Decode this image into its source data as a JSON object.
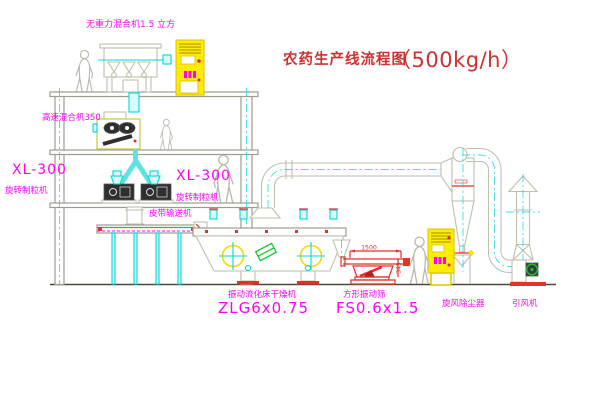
{
  "title": {
    "name": "农药生产线流程图",
    "capacity": "（500kg/h）"
  },
  "labels": {
    "gravity_mixer": "无重力混合机1.5 立方",
    "high_speed_mixer": "高速混合机350",
    "granulator_model_left": "XL-300",
    "granulator_name_left": "旋转制粒机",
    "granulator_model_right": "XL-300",
    "granulator_name_right": "旋转制粒机",
    "belt_conveyor": "皮带输送机",
    "dryer_name": "振动流化床干燥机",
    "dryer_model": "ZLG6x0.75",
    "sieve_name": "方形振动筛",
    "sieve_model": "FS0.6x1.5",
    "cyclone_name": "旋风除尘器",
    "fan_name": "引风机"
  },
  "dimensions": {
    "sieve_length": "1500",
    "sieve_height": "345"
  },
  "colors": {
    "label": "#ff00ff",
    "title": "#cc3232",
    "line": "#bfbfae",
    "cyan": "#00d8d8",
    "yellow": "#ffec00",
    "red": "#e03028",
    "green": "#18c832"
  }
}
